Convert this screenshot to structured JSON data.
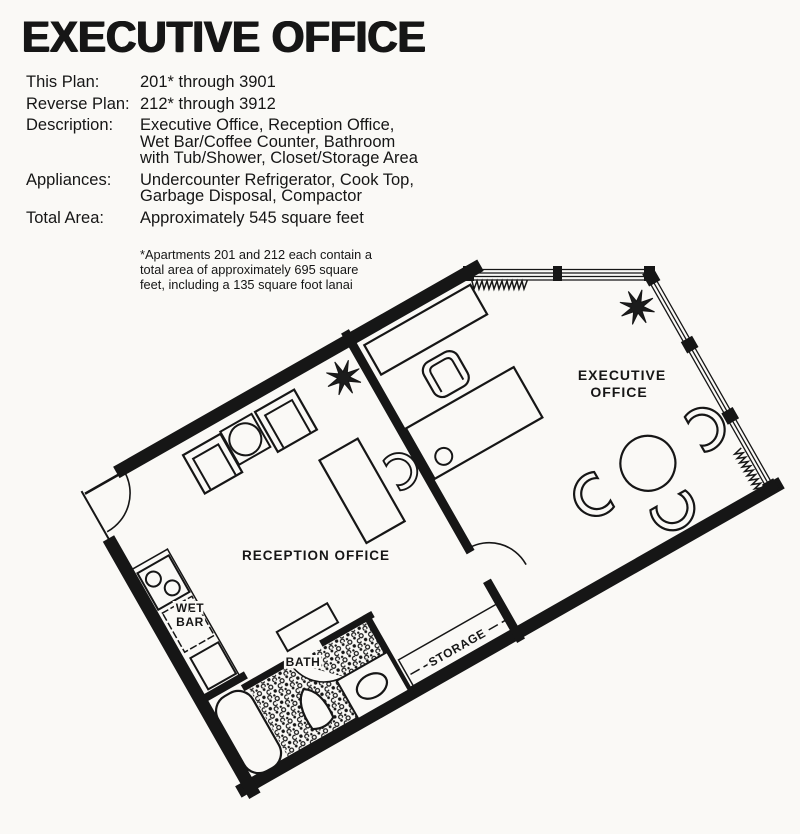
{
  "header": {
    "title": "EXECUTIVE OFFICE",
    "specs": [
      {
        "label": "This Plan:",
        "lines": [
          "201* through 3901"
        ]
      },
      {
        "label": "Reverse Plan:",
        "lines": [
          "212* through 3912"
        ]
      },
      {
        "label": "Description:",
        "lines": [
          "Executive Office, Reception Office,",
          "Wet Bar/Coffee Counter, Bathroom",
          "with Tub/Shower, Closet/Storage Area"
        ]
      },
      {
        "label": "Appliances:",
        "lines": [
          "Undercounter Refrigerator, Cook Top,",
          "Garbage Disposal, Compactor"
        ]
      },
      {
        "label": "Total Area:",
        "lines": [
          "Approximately 545 square feet"
        ]
      }
    ],
    "footnote": [
      "*Apartments 201 and 212 each contain a",
      "total area of approximately 695 square",
      "feet, including a 135 square foot lanai"
    ]
  },
  "plan": {
    "labels": {
      "executive": [
        "EXECUTIVE",
        "OFFICE"
      ],
      "reception": "RECEPTION OFFICE",
      "wet_bar": [
        "WET",
        "BAR"
      ],
      "bath": "BATH",
      "storage": "STORAGE"
    },
    "ink_color": "#161616",
    "paper_color": "#faf9f6"
  }
}
